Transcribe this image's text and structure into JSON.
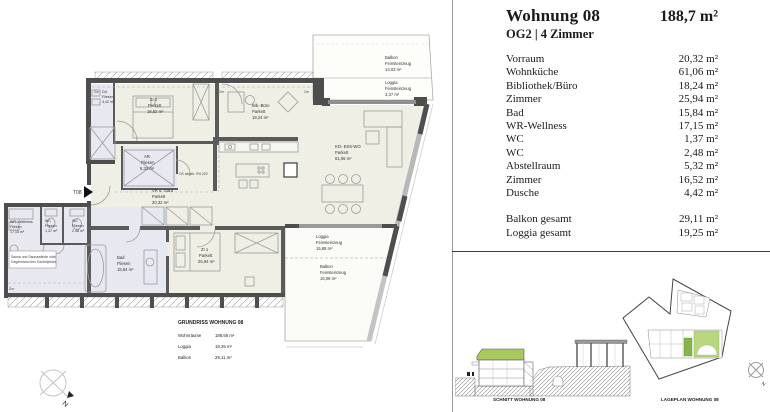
{
  "panel": {
    "title": "Wohnung 08",
    "total_area": "188,7 m²",
    "subtitle": "OG2 | 4 Zimmer",
    "rows": [
      {
        "label": "Vorraum",
        "value": "20,32 m²"
      },
      {
        "label": "Wohnküche",
        "value": "61,06 m²"
      },
      {
        "label": "Bibliothek/Büro",
        "value": "18,24 m²"
      },
      {
        "label": "Zimmer",
        "value": "25,94 m²"
      },
      {
        "label": "Bad",
        "value": "15,84 m²"
      },
      {
        "label": "WR-Wellness",
        "value": "17,15 m²"
      },
      {
        "label": "WC",
        "value": "1,37 m²"
      },
      {
        "label": "WC",
        "value": "2,48 m²"
      },
      {
        "label": "Abstellraum",
        "value": "5,32 m²"
      },
      {
        "label": "Zimmer",
        "value": "16,52 m²"
      },
      {
        "label": "Dusche",
        "value": "4,42 m²"
      }
    ],
    "totals": [
      {
        "label": "Balkon gesamt",
        "value": "29,11 m²"
      },
      {
        "label": "Loggia gesamt",
        "value": "19,25 m²"
      }
    ]
  },
  "plan": {
    "rooms": [
      {
        "name": "DU",
        "floor": "Fliesen",
        "area": "4,42 m²"
      },
      {
        "name": "ZI 2",
        "floor": "Parkett",
        "area": "16,52 m²"
      },
      {
        "name": "AR",
        "floor": "Fliesen",
        "area": "5,32 m²"
      },
      {
        "name": "Bib.-Büro",
        "floor": "Parkett",
        "area": "18,24 m²"
      },
      {
        "name": "KO- ESS-WO",
        "floor": "Parkett",
        "area": "61,06 m²"
      },
      {
        "name": "VR u. Gard",
        "floor": "Parkett",
        "area": "20,32 m²"
      },
      {
        "name": "WR.-Wellness",
        "floor": "Fliesen",
        "area": "17,15 m²"
      },
      {
        "name": "WC",
        "floor": "Fliesen",
        "area": "1,37 m²"
      },
      {
        "name": "WC",
        "floor": "Fliesen",
        "area": "2,48 m²"
      },
      {
        "name": "Bad",
        "floor": "Fliesen",
        "area": "15,84 m²"
      },
      {
        "name": "ZI 1",
        "floor": "Parkett",
        "area": "25,94 m²"
      },
      {
        "name": "Balkon",
        "floor": "Feinsteinzeug",
        "area": "13,03 m²"
      },
      {
        "name": "Loggia",
        "floor": "Feinsteinzeug",
        "area": "3,37 m²"
      },
      {
        "name": "Loggia",
        "floor": "Feinsteinzeug",
        "area": "15,88 m²"
      },
      {
        "name": "Balkon",
        "floor": "Feinsteinzeug",
        "area": "16,08 m²"
      }
    ],
    "note_line1": "Sauna und Saunawände nicht",
    "note_line2": "Gegenstand des Kaufobjektes",
    "ceiling_note": "OK abgeh. RH 220",
    "entry_label": "T08",
    "marker_2m": "2m",
    "north_label": "N",
    "caption": {
      "title": "GRUNDRISS   WOHNUNG 08",
      "rows": [
        {
          "label": "Wohnräume",
          "value": "188,66 m²"
        },
        {
          "label": "Loggia",
          "value": "19,25 m²"
        },
        {
          "label": "Balkon",
          "value": "29,11 m²"
        }
      ]
    }
  },
  "drawings": {
    "schnitt_caption": "SCHNITT   WOHNUNG 08",
    "lageplan_caption": "LAGEPLAN   WOHNUNG 08"
  },
  "colors": {
    "accent_green": "#a8c95e",
    "wall_gray": "#4e4e4e",
    "tile_fill": "#e8e8f1",
    "parquet_fill": "#f0efe6"
  }
}
